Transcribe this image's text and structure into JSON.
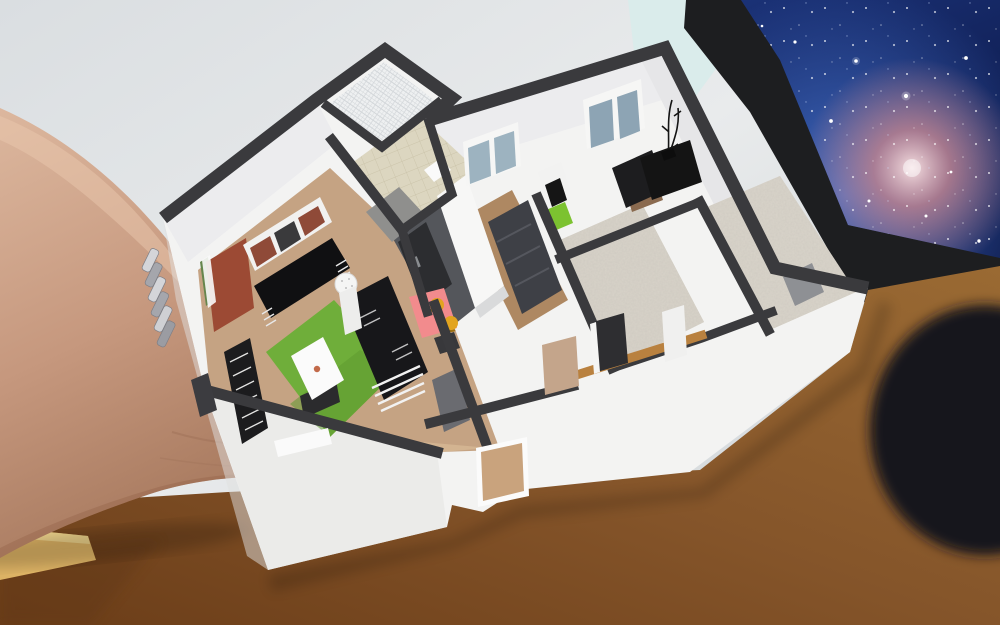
{
  "scene": {
    "description": "Augmented-reality photo: a 3D dollhouse floor-plan model hovering over a wooden desk, presented on a bare forearm with a metal watch; a monitor with a galaxy wallpaper stands in the background against a light grey wall.",
    "colors": {
      "wall_bg_top": "#dadee1",
      "wall_bg_mid": "#e9ebec",
      "wall_bg_bottom": "#c7cdd1",
      "cyan_patch": "#d8eceb",
      "monitor_bezel": "#1d1e20",
      "galaxy_deep": "#0a1543",
      "galaxy_mid": "#1b3277",
      "galaxy_glow": "#4a7ad9",
      "nebula_core": "#f3dde0",
      "nebula_pink": "#c4848e",
      "star_white": "#ffffff",
      "desk_light": "#9a6a33",
      "desk_mid": "#85552a",
      "desk_dark": "#6b3d18",
      "desk_edge_wood": "#dcb264",
      "skin_light": "#dcb79e",
      "skin_mid": "#c6987e",
      "skin_dark": "#a87a5f",
      "watch_silver": "#d4d5d9",
      "watch_silver_dark": "#a5a6ac",
      "mouse_black": "#17121a",
      "model_wall_white": "#f3f3f2",
      "model_wall_face": "#ececee",
      "model_wall_top": "#3a3a3d",
      "living_wood": "#c5a383",
      "rug_green": "#6fae3a",
      "coffee_table_white": "#fbfbfb",
      "sofa_black": "#17171a",
      "tv_unit_black": "#101012",
      "shelf_red": "#8f4a38",
      "door_red": "#9c4a34",
      "door_tan": "#c9a37d",
      "kitchen_floor_gray": "#54565b",
      "counter_dark": "#2c2d30",
      "island_white": "#f7f7f6",
      "table_pink": "#f28b8d",
      "chair_yellow": "#e2a41f",
      "lime_green": "#7cc230",
      "bath_tile": "#dcd6c0",
      "shower_gray": "#8f8f8d",
      "hall_wood": "#ae8862",
      "hall_sofa_gray": "#3e4046",
      "carpet_beige": "#d8d3c9",
      "door_gray": "#8e9094",
      "window_pane": "#9db3c0",
      "window_pane_dark": "#8da4b4",
      "wood_wall_top": "#b9813f"
    },
    "objects": [
      {
        "name": "background-wall",
        "label": "light grey room wall"
      },
      {
        "name": "monitor",
        "label": "desktop monitor with galaxy wallpaper"
      },
      {
        "name": "desk",
        "label": "brown wooden desk"
      },
      {
        "name": "forearm",
        "label": "bare forearm with metal watch"
      },
      {
        "name": "floorplan-model",
        "label": "AR 3D apartment floor plan"
      },
      {
        "name": "living-room",
        "label": "living room: wood floor, green rug, white coffee table, black sofa, black TV unit, shelf, red door"
      },
      {
        "name": "kitchen",
        "label": "kitchen: grey floor, white island, dark counters, pink dining table, yellow chairs"
      },
      {
        "name": "bathroom",
        "label": "beige tiled bathroom with grey shower"
      },
      {
        "name": "balcony",
        "label": "small balcony with white lattice floor"
      },
      {
        "name": "hallway",
        "label": "hall with wooden floor and grey sofa"
      },
      {
        "name": "bedrooms",
        "label": "carpeted rooms with black desk and twig vase"
      },
      {
        "name": "front-door",
        "label": "tan front door in white facade"
      }
    ]
  }
}
